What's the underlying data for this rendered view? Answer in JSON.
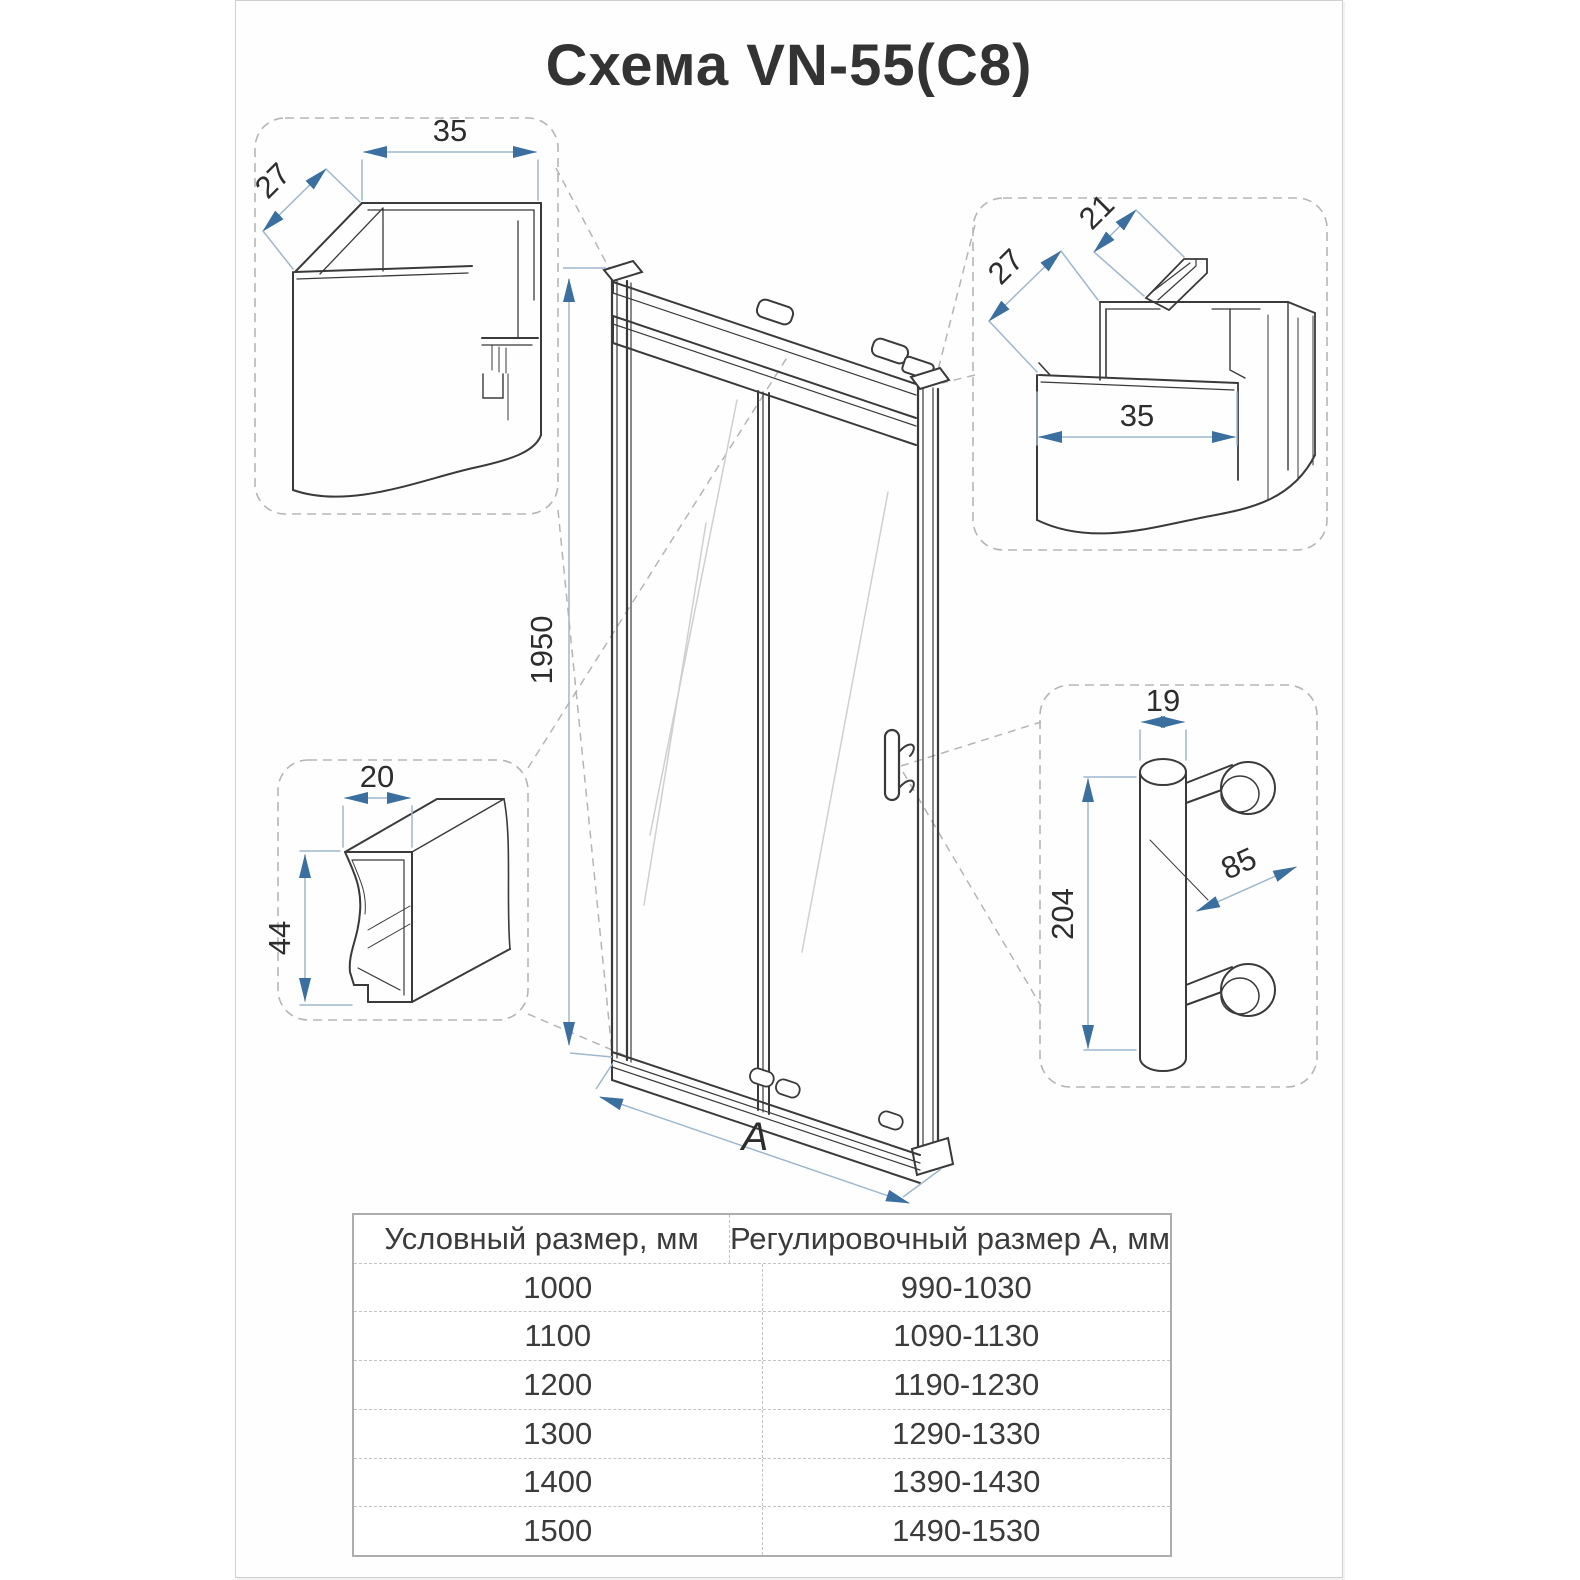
{
  "title": "Схема VN-55(C8)",
  "main_drawing": {
    "door_height": "1950",
    "door_width_label": "A"
  },
  "details": {
    "wall_profile_left": {
      "width": "35",
      "depth": "27"
    },
    "wall_profile_right": {
      "clip_width": "21",
      "depth": "27",
      "width": "35"
    },
    "rail_profile": {
      "width": "20",
      "height": "44"
    },
    "handle": {
      "diameter": "19",
      "length": "204",
      "mount_offset": "85"
    }
  },
  "table": {
    "headers": [
      "Условный размер, мм",
      "Регулировочный размер А, мм"
    ],
    "rows": [
      [
        "1000",
        "990-1030"
      ],
      [
        "1100",
        "1090-1130"
      ],
      [
        "1200",
        "1190-1230"
      ],
      [
        "1300",
        "1290-1330"
      ],
      [
        "1400",
        "1390-1430"
      ],
      [
        "1500",
        "1490-1530"
      ]
    ]
  },
  "colors": {
    "line_art": "#3a3a3a",
    "dimension_line": "#9db7cd",
    "dimension_arrow": "#3a6f9f",
    "callout_dash": "#b5b5b5"
  }
}
